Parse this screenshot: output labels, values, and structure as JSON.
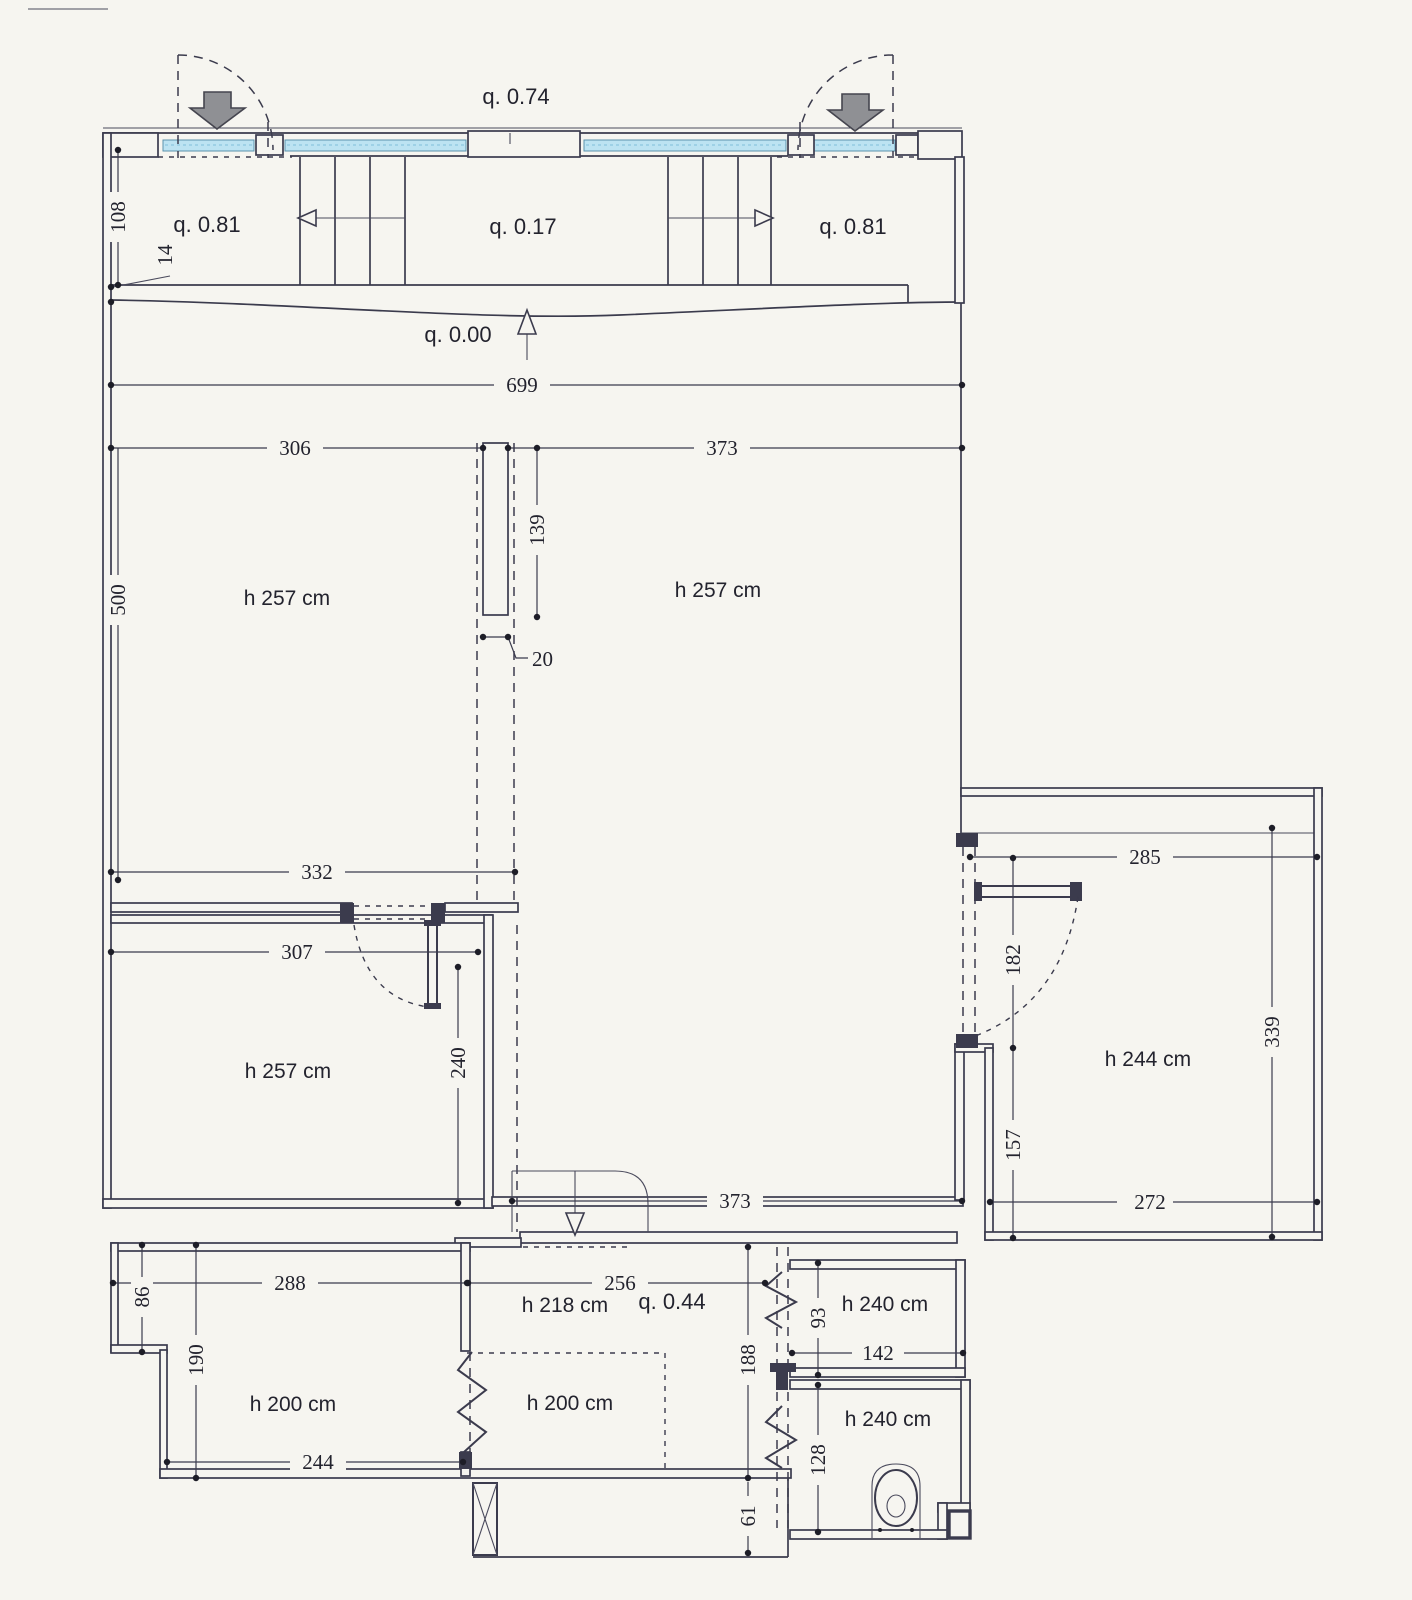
{
  "drawing": {
    "type": "floor-plan",
    "levels": {
      "entry": "q. 0.74",
      "left_landing": "q. 0.81",
      "mid_landing": "q. 0.17",
      "right_landing": "q. 0.81",
      "ground": "q. 0.00",
      "lower": "q. 0.44"
    },
    "rooms": {
      "left": "h 257 cm",
      "main": "h 257 cm",
      "lower_left": "h 257 cm",
      "right": "h 244 cm",
      "bottom_left": "h 200 cm",
      "bottom_mid": "h 218 cm",
      "bottom_mid_inner": "h 200 cm",
      "store": "h 240 cm",
      "wc": "h 240 cm"
    },
    "dimensions": {
      "d108": "108",
      "d14": "14",
      "d699": "699",
      "d306": "306",
      "d373_top": "373",
      "d139": "139",
      "d20": "20",
      "d500": "500",
      "d332": "332",
      "d307": "307",
      "d240": "240",
      "d373_bottom": "373",
      "d285": "285",
      "d182": "182",
      "d339": "339",
      "d157": "157",
      "d272": "272",
      "d288": "288",
      "d86": "86",
      "d190": "190",
      "d244": "244",
      "d256": "256",
      "d188": "188",
      "d61": "61",
      "d93": "93",
      "d142": "142",
      "d128": "128"
    },
    "colors": {
      "paper": "#f6f5f0",
      "line": "#3b3b4d",
      "window_glass": "#bce3f2",
      "entry_arrow": "#8f9094"
    }
  }
}
